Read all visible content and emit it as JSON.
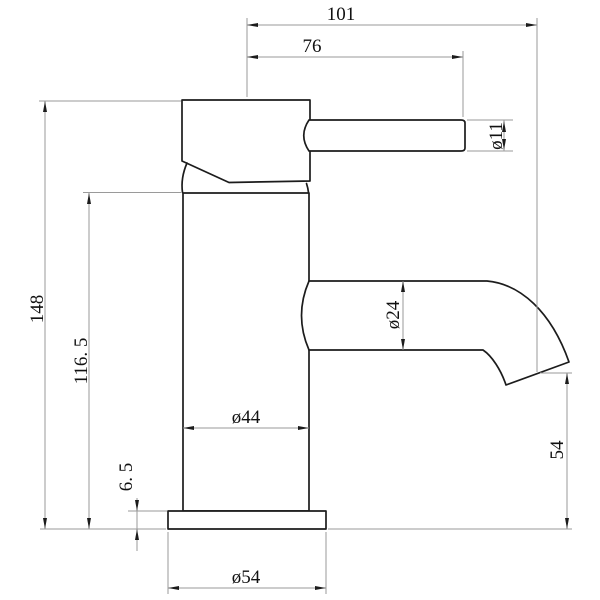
{
  "drawing": {
    "kind": "faucet-technical-drawing",
    "view": "side-elevation"
  },
  "dimensions": {
    "spout_reach": "101",
    "handle_reach": "76",
    "handle_diameter": "ø11",
    "overall_height": "148",
    "body_height": "116. 5",
    "spout_diameter": "ø24",
    "body_diameter": "ø44",
    "base_thickness": "6. 5",
    "outlet_height": "54",
    "base_diameter": "ø54"
  },
  "colors": {
    "background": "#ffffff",
    "outline": "#1c1c1c",
    "dimension_lines": "#9a9a9a",
    "text": "#111111"
  }
}
